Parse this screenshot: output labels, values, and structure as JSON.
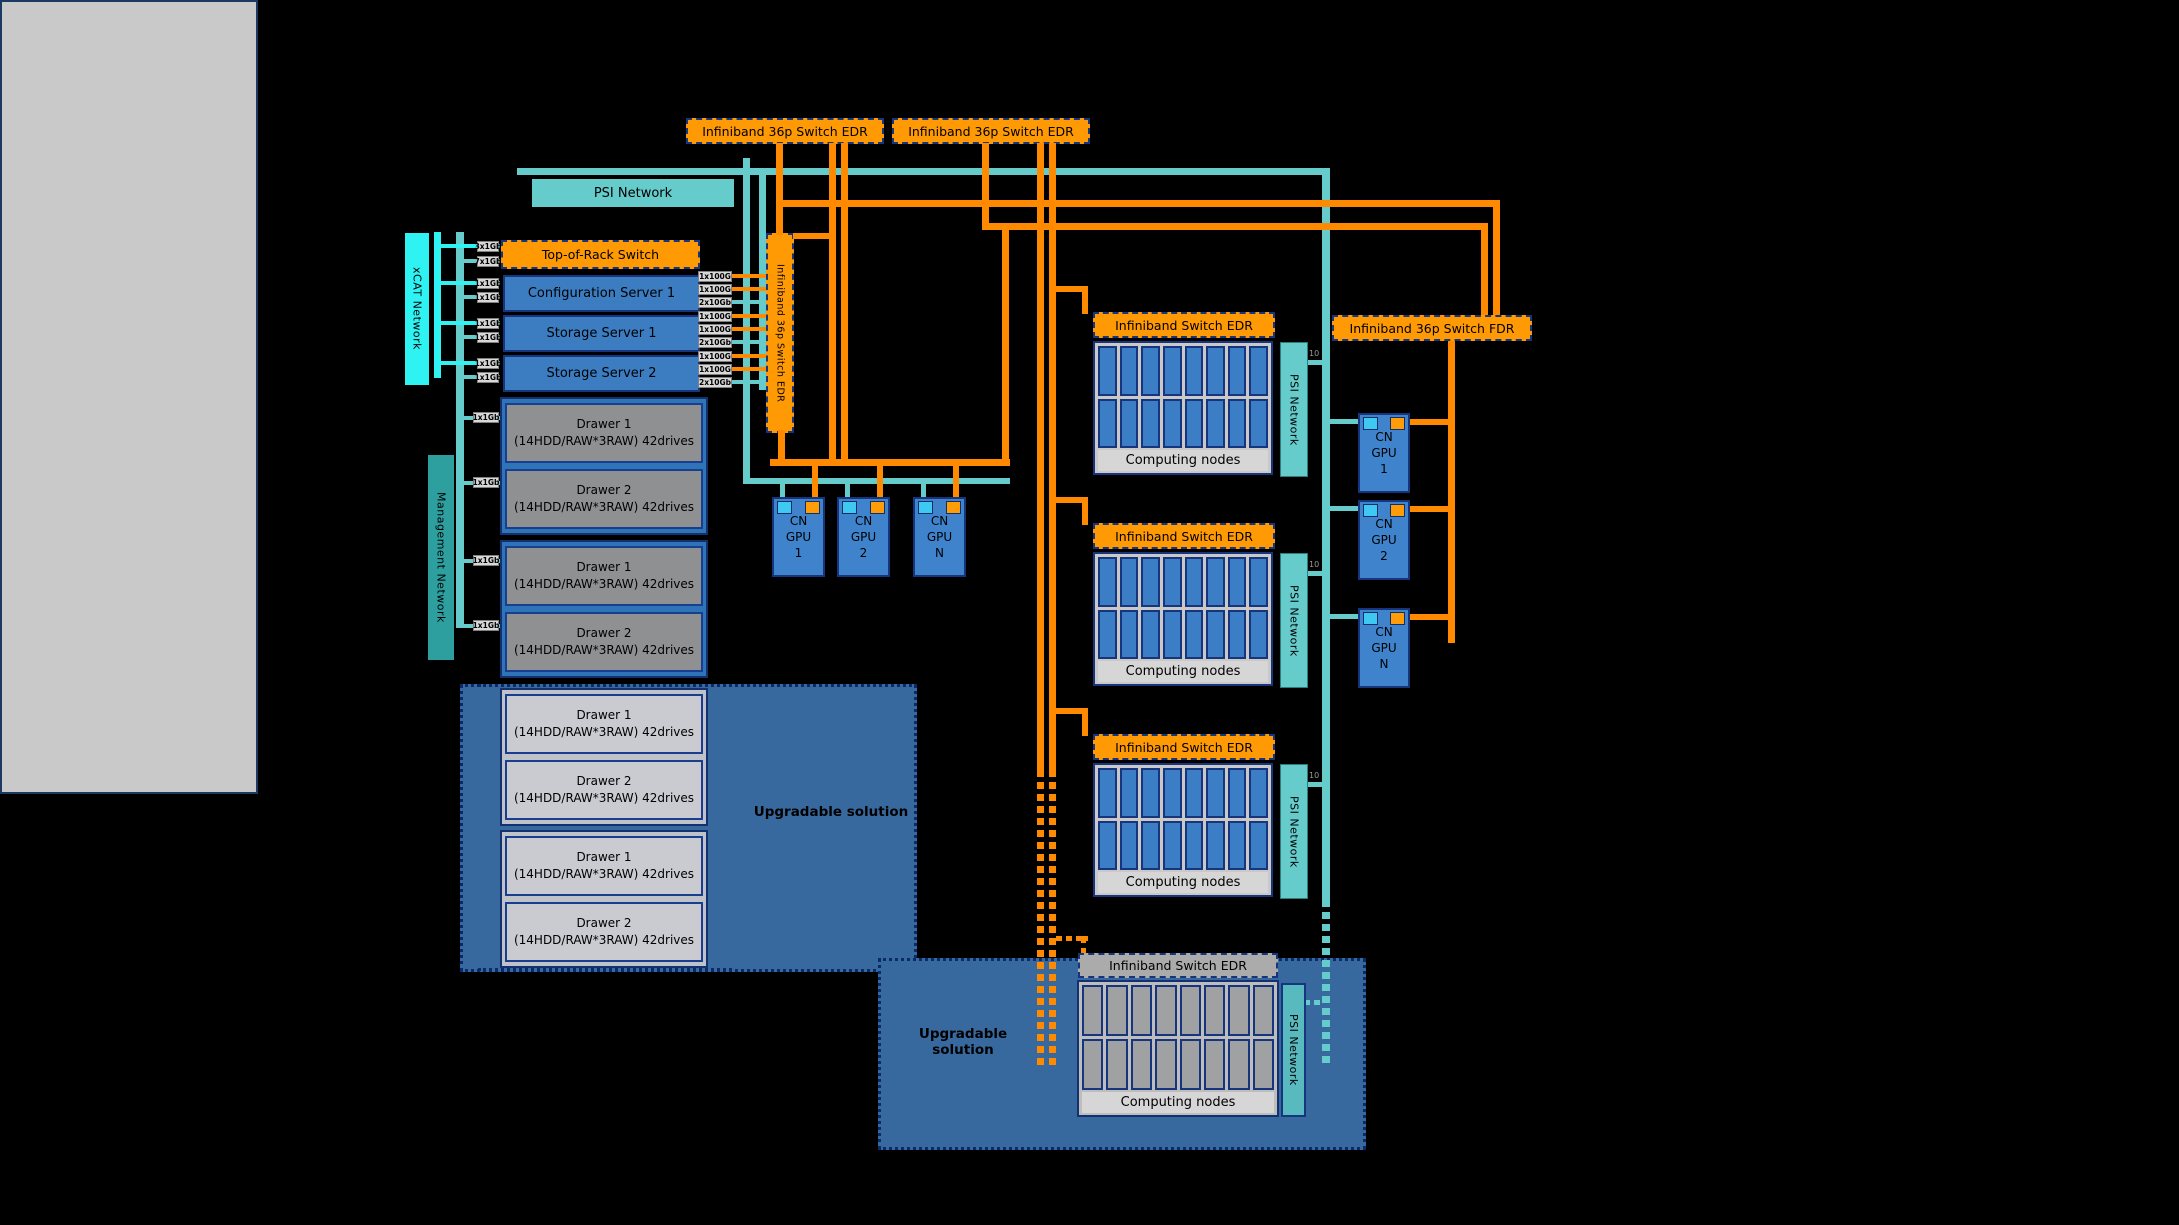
{
  "colors": {
    "orange": "#FF9A05",
    "oline": "#FF8A00",
    "teal": "#66CBCB",
    "cyan": "#2FF3F3",
    "mgmt": "#2D9F9F",
    "navy": "#16357D",
    "srvblue": "#3C7DC2",
    "nodeblue": "#3B7EC6",
    "gpublue": "#3E83CC",
    "encblue": "#2E74B6",
    "chipcyan": "#3FC9F2",
    "chiporange": "#FF9C07",
    "steel": "#38699E"
  },
  "diagram": {
    "top_switch_1": "Infiniband 36p Switch EDR",
    "top_switch_2": "Infiniband 36p Switch EDR",
    "psi_top": "PSI Network",
    "xcat_bar": "xCAT Network",
    "mgmt_bar": "Management Network",
    "vertical_switch": "Infiniband 36p Switch EDR",
    "fdr_switch": "Infiniband 36p Switch FDR",
    "upgradable_storage": "Upgradable solution",
    "upgradable_compute": "Upgradable solution",
    "rack": {
      "tor_switch": "Top-of-Rack Switch",
      "servers": [
        "Configuration Server 1",
        "Storage Server 1",
        "Storage Server 2"
      ],
      "left_ports": [
        "3x1Gb",
        "7x1Gb",
        "1x1Gb",
        "1x1Gb",
        "1x1Gb",
        "1x1Gb",
        "1x1Gb",
        "1x1Gb"
      ],
      "drawer_ports": [
        "1x1Gb",
        "1x1Gb",
        "1x1Gb",
        "1x1Gb"
      ],
      "right_ports": [
        "1x100G",
        "1x100G",
        "2x10Gb",
        "1x100G",
        "1x100G",
        "2x10Gb",
        "1x100G",
        "1x100G",
        "2x10Gb"
      ],
      "enclosures": [
        {
          "drawers": [
            {
              "name": "Drawer 1",
              "spec": "(14HDD/RAW*3RAW) 42drives"
            },
            {
              "name": "Drawer 2",
              "spec": "(14HDD/RAW*3RAW) 42drives"
            }
          ]
        },
        {
          "drawers": [
            {
              "name": "Drawer 1",
              "spec": "(14HDD/RAW*3RAW) 42drives"
            },
            {
              "name": "Drawer 2",
              "spec": "(14HDD/RAW*3RAW) 42drives"
            }
          ]
        },
        {
          "drawers": [
            {
              "name": "Drawer 1",
              "spec": "(14HDD/RAW*3RAW) 42drives"
            },
            {
              "name": "Drawer 2",
              "spec": "(14HDD/RAW*3RAW) 42drives"
            }
          ]
        },
        {
          "drawers": [
            {
              "name": "Drawer 1",
              "spec": "(14HDD/RAW*3RAW) 42drives"
            },
            {
              "name": "Drawer 2",
              "spec": "(14HDD/RAW*3RAW) 42drives"
            }
          ]
        }
      ],
      "gpfs_label": "GPFS"
    },
    "gpu_nodes_left": [
      {
        "lines": [
          "CN",
          "GPU",
          "1"
        ]
      },
      {
        "lines": [
          "CN",
          "GPU",
          "2"
        ]
      },
      {
        "lines": [
          "CN",
          "GPU",
          "N"
        ]
      }
    ],
    "gpu_nodes_right": [
      {
        "lines": [
          "CN",
          "GPU",
          "1"
        ]
      },
      {
        "lines": [
          "CN",
          "GPU",
          "2"
        ]
      },
      {
        "lines": [
          "CN",
          "GPU",
          "N"
        ]
      }
    ],
    "compute_groups": [
      {
        "switch_label": "Infiniband Switch EDR",
        "nodes_label": "Computing nodes",
        "psi_label": "PSI Network",
        "uplink_label": "10"
      },
      {
        "switch_label": "Infiniband Switch EDR",
        "nodes_label": "Computing nodes",
        "psi_label": "PSI Network",
        "uplink_label": "10"
      },
      {
        "switch_label": "Infiniband Switch EDR",
        "nodes_label": "Computing nodes",
        "psi_label": "PSI Network",
        "uplink_label": "10"
      }
    ],
    "future_group": {
      "switch_label": "Infiniband Switch EDR",
      "nodes_label": "Computing nodes",
      "psi_label": "PSI Network"
    }
  }
}
